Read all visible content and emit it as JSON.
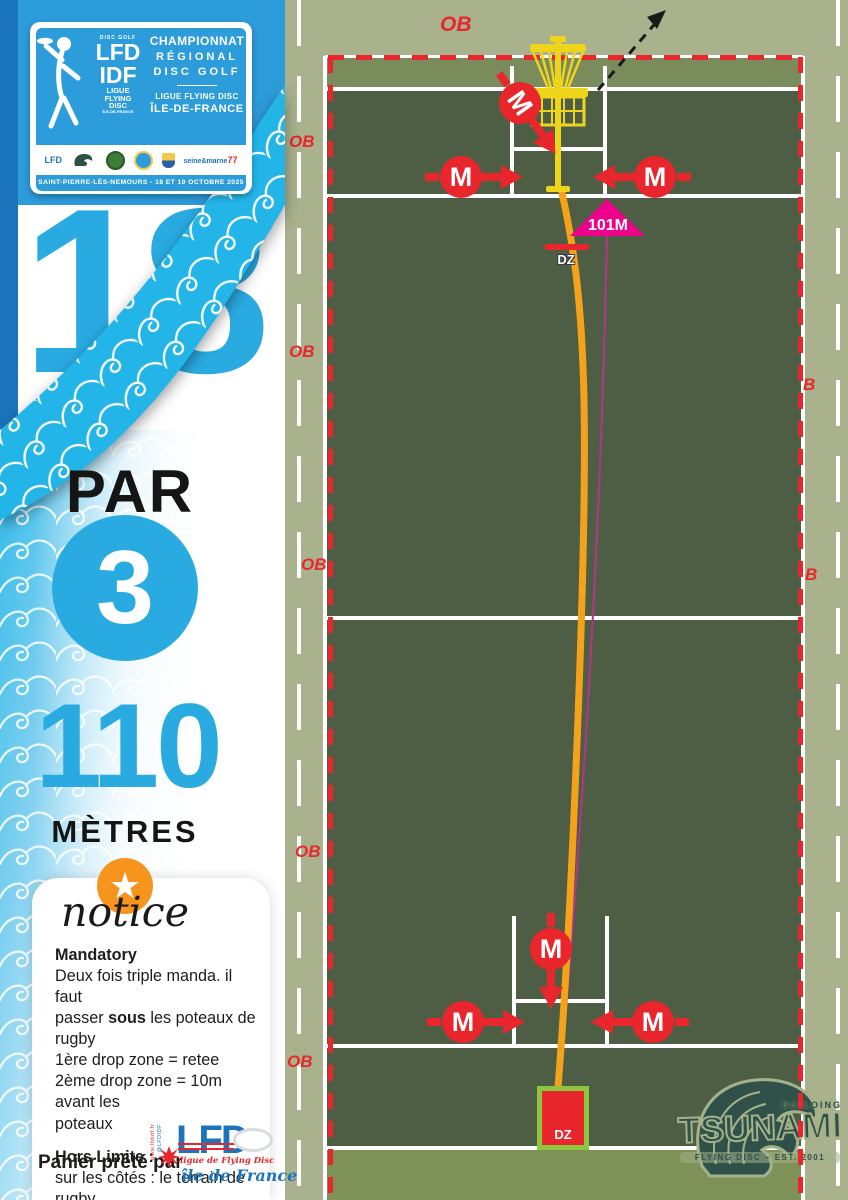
{
  "poster": {
    "badge": {
      "discgolf": "DISC GOLF",
      "lfd": "LFD",
      "idf": "IDF",
      "l1": "LIGUE",
      "l2": "FLYING",
      "l3": "DISC",
      "l4": "ÎLE-DE-FRANCE"
    },
    "title1": "CHAMPIONNAT",
    "title2": "RÉGIONAL",
    "title3": "DISC GOLF",
    "sub1": "LIGUE FLYING DISC",
    "sub2": "ÎLE-DE-FRANCE",
    "banner": "SAINT-PIERRE-LÈS-NEMOURS - 18 ET 19 OCTOBRE 2025",
    "sponsors": {
      "lfd": "LFD",
      "tsunami": "TSUNAMI",
      "seine": "seine&marne",
      "dept": "77"
    }
  },
  "hole": {
    "number": "18",
    "par_label": "PAR",
    "par": "3",
    "distance": "110",
    "unit": "MÈTRES"
  },
  "notice": {
    "star": "★",
    "title": "notice",
    "mandatory_title": "Mandatory",
    "m1": "Deux fois triple manda. il faut",
    "m2a": "passer ",
    "m2b": "sous",
    "m2c": " les poteaux de rugby",
    "m3": "1ère drop zone = retee",
    "m4": "2ème drop zone = 10m avant les",
    "m5": "poteaux",
    "ob_title": "Hors Limite :",
    "o1": "sur les côtés : le terrain de rugby.",
    "o2": "au fond : derrière la main",
    "o3": "courante"
  },
  "credit": {
    "label": "Panier prêté par",
    "lfd": "LFD",
    "line1": "ligue de Flying Disc",
    "line2": "île de France",
    "web": "www.lfdidf.fr",
    "handle": "@LFDIDF"
  },
  "map": {
    "ob": "OB",
    "ob_partial": "B",
    "mando": "M",
    "distance_marker": "101M",
    "dz": "DZ"
  },
  "tsunami": {
    "top": "DU LOING",
    "name": "TSUNAMI",
    "bottom": "FLYING DISC – EST. 2001"
  },
  "colors": {
    "blue": "#29ABE2",
    "cyan": "#24B5E8",
    "dark_blue": "#1B75BC",
    "red": "#E8262C",
    "magenta": "#EC008C",
    "orange": "#F5A21B",
    "yellow": "#EFD41C",
    "field_dark": "#4D5E44",
    "field_light": "#A9B28C"
  }
}
